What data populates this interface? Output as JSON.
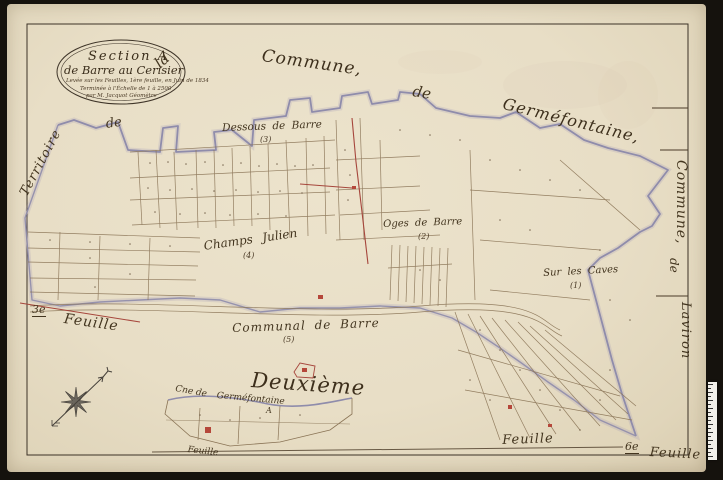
{
  "cartouche": {
    "line1": "Section A",
    "line2": "de Barre au Cerisier",
    "line3": "Levée sur les Feuilles, 1ère feuille, en Juin de 1834",
    "line4": "Terminée à l'Échelle de 1 à 2500",
    "line5": "par M. Jacquot Géomètre"
  },
  "margin_labels": {
    "left": {
      "territoire": "Territoire",
      "de": "de"
    },
    "top": {
      "la": "la",
      "commune": "Commune,",
      "de": "de",
      "germefontaine": "Germéfontaine,"
    },
    "right": {
      "commune": "Commune,",
      "de": "de",
      "laviron": "Laviron"
    }
  },
  "place_labels": [
    {
      "name": "Dessous de Barre",
      "num": "(3)"
    },
    {
      "name": "Champs Julien",
      "num": "(4)"
    },
    {
      "name": "Oges de Barre",
      "num": "(2)"
    },
    {
      "name": "Sur les Caves",
      "num": "(1)"
    },
    {
      "name": "Communal de Barre",
      "num": "(5)"
    }
  ],
  "sheet_labels": {
    "deuxieme": "Deuxième",
    "troisieme_num": "3e",
    "troisieme_feuille": "Feuille",
    "enclave_cne": "Cne de",
    "enclave_commune": "Germéfontaine",
    "enclave_feuille": "Feuille",
    "bottom_feuille": "Feuille",
    "sixieme_num": "6e",
    "sixieme_feuille": "Feuille",
    "a_mark": "A"
  },
  "colors": {
    "paper": "#e8dec6",
    "background": "#15120d",
    "boundary_blue": "#8f8cab",
    "ink": "#43351f",
    "red": "#a6463c"
  }
}
